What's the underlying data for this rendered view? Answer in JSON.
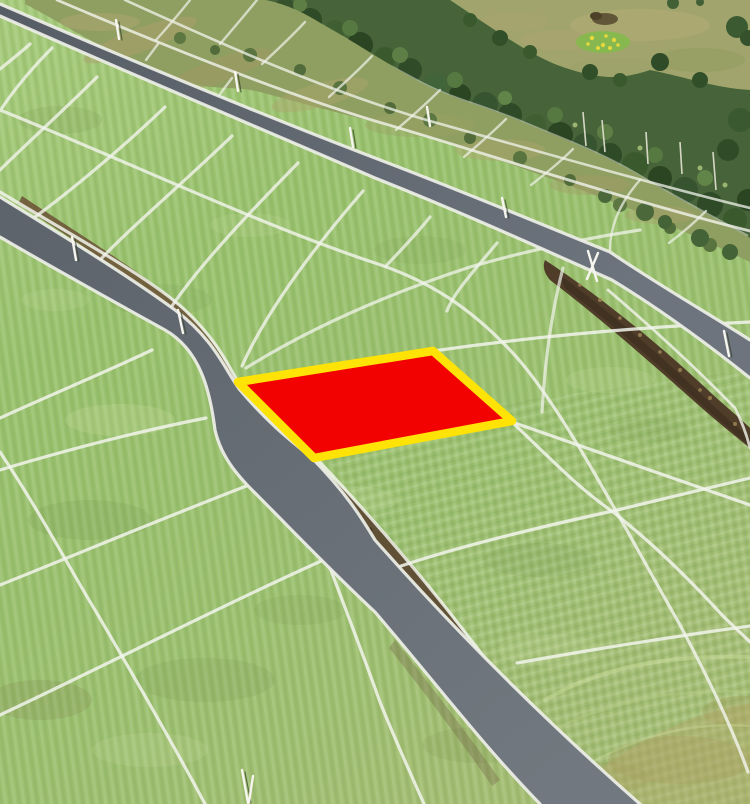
{
  "scene": {
    "kind": "aerial-photo",
    "subject": "aerial view of subdivided green land parcels separated by white boundary lines, two gray roads sweeping diagonally, a birch-forest belt and wild meadow at the top right, and one land plot highlighted in red with a yellow outline"
  },
  "highlight_plot": {
    "fill": "#f30202",
    "stroke": "#ffe206",
    "stroke_width": "8.5"
  },
  "palette": {
    "grass_light": "#a6cb7b",
    "grass_mid": "#98c16c",
    "parcel_line": "#f2f4ec",
    "road_edge_line": "#eef0e8",
    "road_dark": "#596068",
    "road_light": "#6f767f",
    "dirt": "#4f3d29",
    "forest": "#466339",
    "meadow": "#a1a46d",
    "scrub": "#8f9e61",
    "pole": "#f6f6ef"
  }
}
